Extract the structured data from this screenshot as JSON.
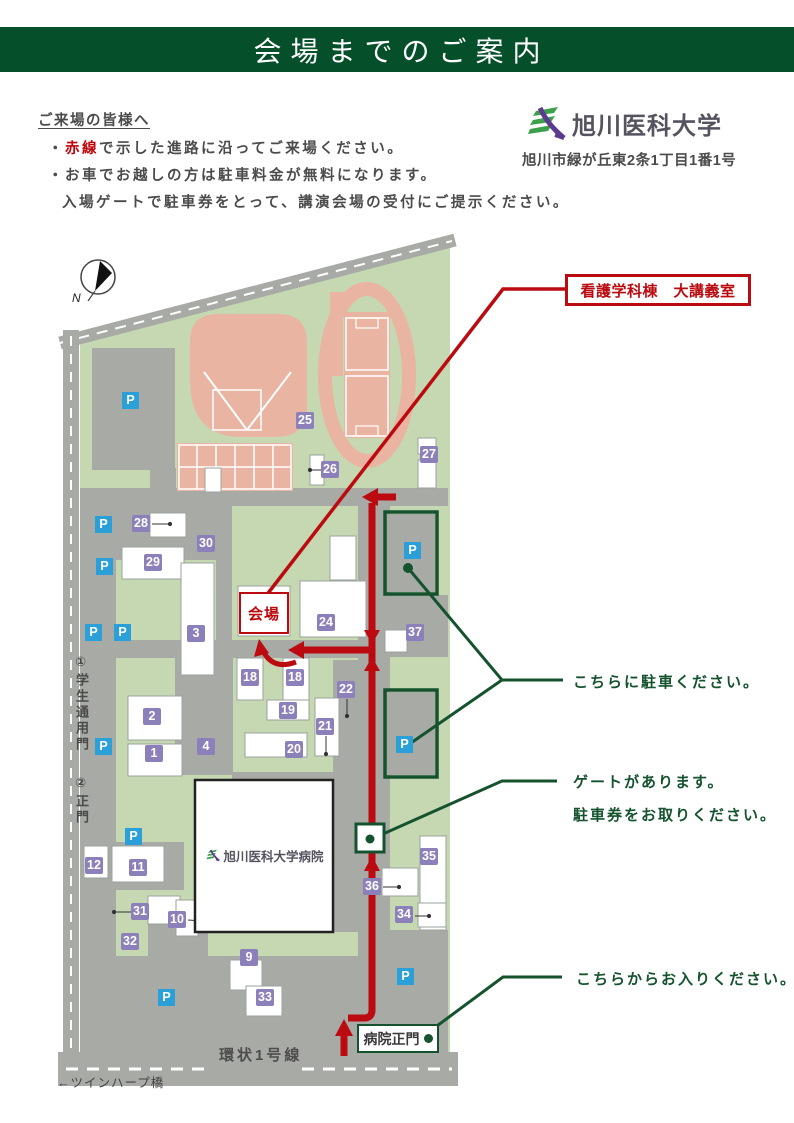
{
  "banner": {
    "title": "会場までのご案内"
  },
  "intro": {
    "heading": "ご来場の皆様へ",
    "b1_prefix": "・",
    "b1_red": "赤線",
    "b1_rest": "で示した進路に沿ってご来場ください。",
    "line2": "・お車でお越しの方は駐車料金が無料になります。",
    "line3": "入場ゲートで駐車券をとって、講演会場の受付にご提示ください。"
  },
  "university": {
    "name": "旭川医科大学",
    "address": "旭川市緑が丘東2条1丁目1番1号"
  },
  "map": {
    "destination_label": "看護学科棟　大講義室",
    "venue_label": "会場",
    "hospital_name": "旭川医科大学病院",
    "hospital_gate_label": "病院正門",
    "road_label": "環状1号線",
    "bridge_label": "←ツインハープ橋",
    "gate1_label": "①学生通用門",
    "gate2_label": "②正門",
    "compass_label": "N",
    "parking_icon": "P",
    "annotations": {
      "park_here": "こちらに駐車ください。",
      "gate_line1": "ゲートがあります。",
      "gate_line2": "駐車券をお取りください。",
      "enter_here": "こちらからお入りください。"
    },
    "buildings": [
      "25",
      "26",
      "27",
      "28",
      "29",
      "30",
      "3",
      "2",
      "1",
      "4",
      "18",
      "18",
      "19",
      "20",
      "21",
      "22",
      "24",
      "37",
      "12",
      "11",
      "31",
      "10",
      "32",
      "9",
      "33",
      "35",
      "36",
      "34"
    ]
  },
  "colors": {
    "banner_green": "#05502a",
    "accent_red": "#bb0b10",
    "accent_green": "#15522e",
    "map_green": "#c5d8b2",
    "field_salmon": "#e9b4a2",
    "road_gray": "#a8aaa6",
    "label_purple": "#8c80ba",
    "parking_blue": "#2b9fd8"
  }
}
